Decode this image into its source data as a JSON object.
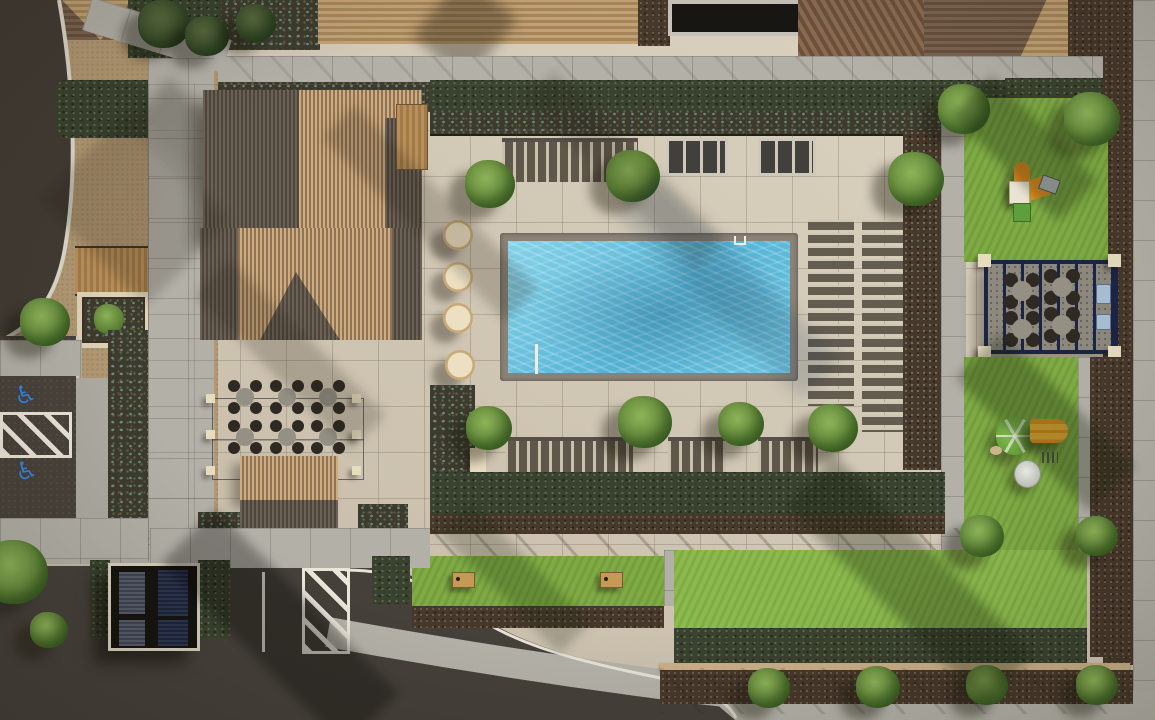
{
  "scene": {
    "description": "Top-down aerial 3D rendering of an apartment community pool courtyard with clubhouse, playgrounds, pergola and parking",
    "view": "overhead site plan rendering",
    "lighting": "afternoon sun from upper right, long shadows to lower left",
    "visible_text": "none"
  },
  "accessibility": {
    "symbol": "♿",
    "spaces": 2,
    "symbol_color": "#3b82d8"
  },
  "amenities": {
    "pool": "rectangular swimming pool with gray coping and two handrails",
    "round_daybeds": 4,
    "sun_lounger_columns": 2,
    "sun_loungers_approx": 30,
    "cabana_bench_groups": 3,
    "patio_dining_tables": 6,
    "chairs_per_table": 4,
    "pergola_picnic_tables": 4,
    "bbq_grills": 2,
    "cornhole_boards": 2,
    "playgrounds": 2,
    "dome_climber": 1,
    "slide_structures": 2,
    "planter_boxes": 1,
    "boardwalk_bridge": 1,
    "trash_enclosure_roof_panels": 4
  },
  "palette": {
    "pool_deck": "#d3c9b8",
    "pool_water_light": "#86d2e8",
    "pool_water_dark": "#4fa8cc",
    "pool_coping": "#8a8276",
    "lawn": "#7aa83f",
    "lawn_bright": "#87b748",
    "hedge_dark": "#39422e",
    "mulch": "#46382b",
    "road_asphalt": "#45403a",
    "sidewalk_gray": "#b3b0a8",
    "path_tan": "#b29873",
    "roof_tile_tan": "#cfac7d",
    "roof_tile_dark": "#6d6155",
    "roof_shingle_brown": "#7c6350",
    "pergola_navy": "#1c2446",
    "post_cream": "#e7dcbe",
    "daybed_cream": "#ecdfc2",
    "play_orange": "#e08a20",
    "slide_yellow": "#f2b636",
    "dome_green": "#7cb84a",
    "table_gray": "#95908a",
    "chair_dark": "#2e2922",
    "marking_white": "#eae6da",
    "handicap_blue": "#3b82d8",
    "grill_blue": "#a9c0d4",
    "wood": "#b98f5a"
  }
}
